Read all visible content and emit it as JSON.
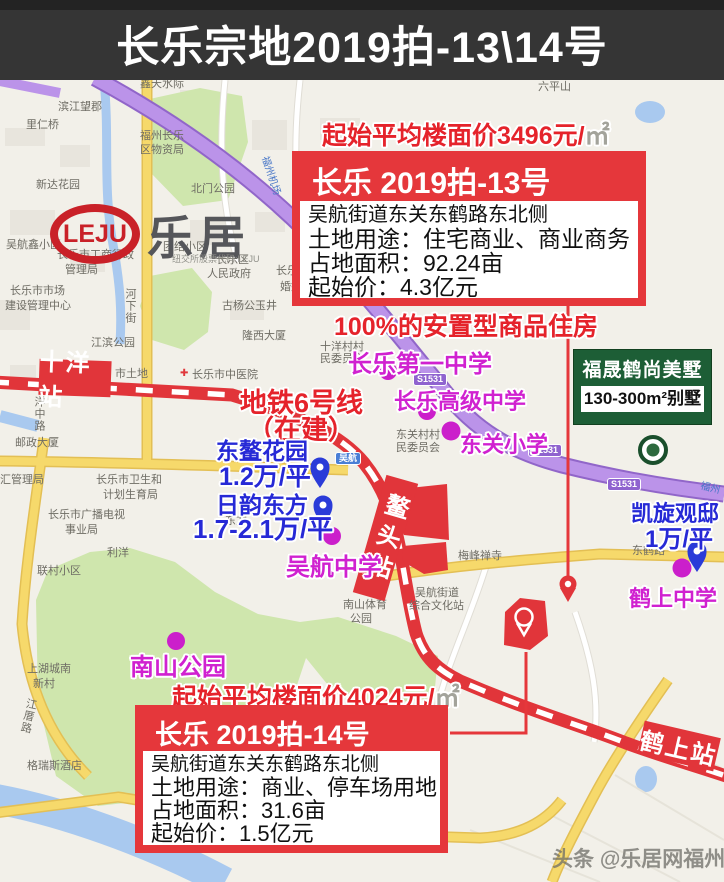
{
  "title": "长乐宗地2019拍-13\\14号",
  "watermark": "头条 @乐居网福州",
  "logo": {
    "latin": "LEJU",
    "cn": "乐居",
    "tagline": "纽交所股票代码:LEJU"
  },
  "parcel13": {
    "floor_price": "起始平均楼面价3496元/",
    "floor_price_unit": "㎡",
    "header": "长乐 2019拍-13号",
    "address": "吴航街道东关东鹤路东北侧",
    "use": "土地用途：住宅商业、商业商务",
    "area": "占地面积：92.24亩",
    "start_price": "起始价：4.3亿元",
    "note": "100%的安置型商品住房"
  },
  "parcel14": {
    "floor_price": "起始平均楼面价4024元/",
    "floor_price_unit": "㎡",
    "header": "长乐 2019拍-14号",
    "address": "吴航街道东关东鹤路东北侧",
    "use": "土地用途：商业、停车场用地",
    "area": "占地面积：31.6亩",
    "start_price": "起始价：1.5亿元"
  },
  "project": {
    "name": "福晟鹤尚美墅",
    "spec": "130-300m²别墅"
  },
  "metro": {
    "line": "地铁6号线",
    "status": "（在建）",
    "station_shiyang": "十洋站",
    "station_aotou": "鳌头站",
    "station_heshang": "鹤上站"
  },
  "estates": {
    "e1_name": "东鳌花园",
    "e1_price": "1.2万/平",
    "e2_name": "日韵东方",
    "e2_price": "1.7-2.1万/平",
    "e3_name": "凯旋观邸",
    "e3_price": "1万/平"
  },
  "schools": {
    "s1": "长乐第一中学",
    "s2": "长乐高级中学",
    "s3": "东关小学",
    "s4": "吴航中学",
    "s5": "鹤上中学",
    "park": "南山公园"
  },
  "badges": {
    "s1531": "S1531",
    "wuhang": "吴航"
  },
  "icons": {
    "hospital_cross": "✚"
  },
  "map_labels": [
    "鑫天水际",
    "滨江望郡",
    "里仁桥",
    "福州长乐",
    "区物资局",
    "新达花园",
    "北门公园",
    "六平山",
    "吴航鑫小区",
    "长乐市工商行政",
    "管理局",
    "团结小区",
    "长乐区",
    "人民政府",
    "长乐市市场",
    "建设管理中心",
    "河下街",
    "江滨公园",
    "古杨公玉井",
    "隆西大厦",
    "十洋村村",
    "民委员会",
    "市土地",
    "长乐市中医院",
    "洋中路",
    "邮政大厦",
    "汇管理局",
    "长乐市卫生和",
    "计划生育局",
    "长乐市广播电视",
    "事业局",
    "南山体育",
    "公园",
    "东关村村",
    "民委员会",
    "梅峰禅寺",
    "吴航街道",
    "综合文化站",
    "东鹤路",
    "联村小区",
    "利洋",
    "上湖城南",
    "新村",
    "格瑞斯酒店",
    "福州机场",
    "福州",
    "江厝路",
    "东方",
    "婚姻",
    "长乐"
  ]
}
